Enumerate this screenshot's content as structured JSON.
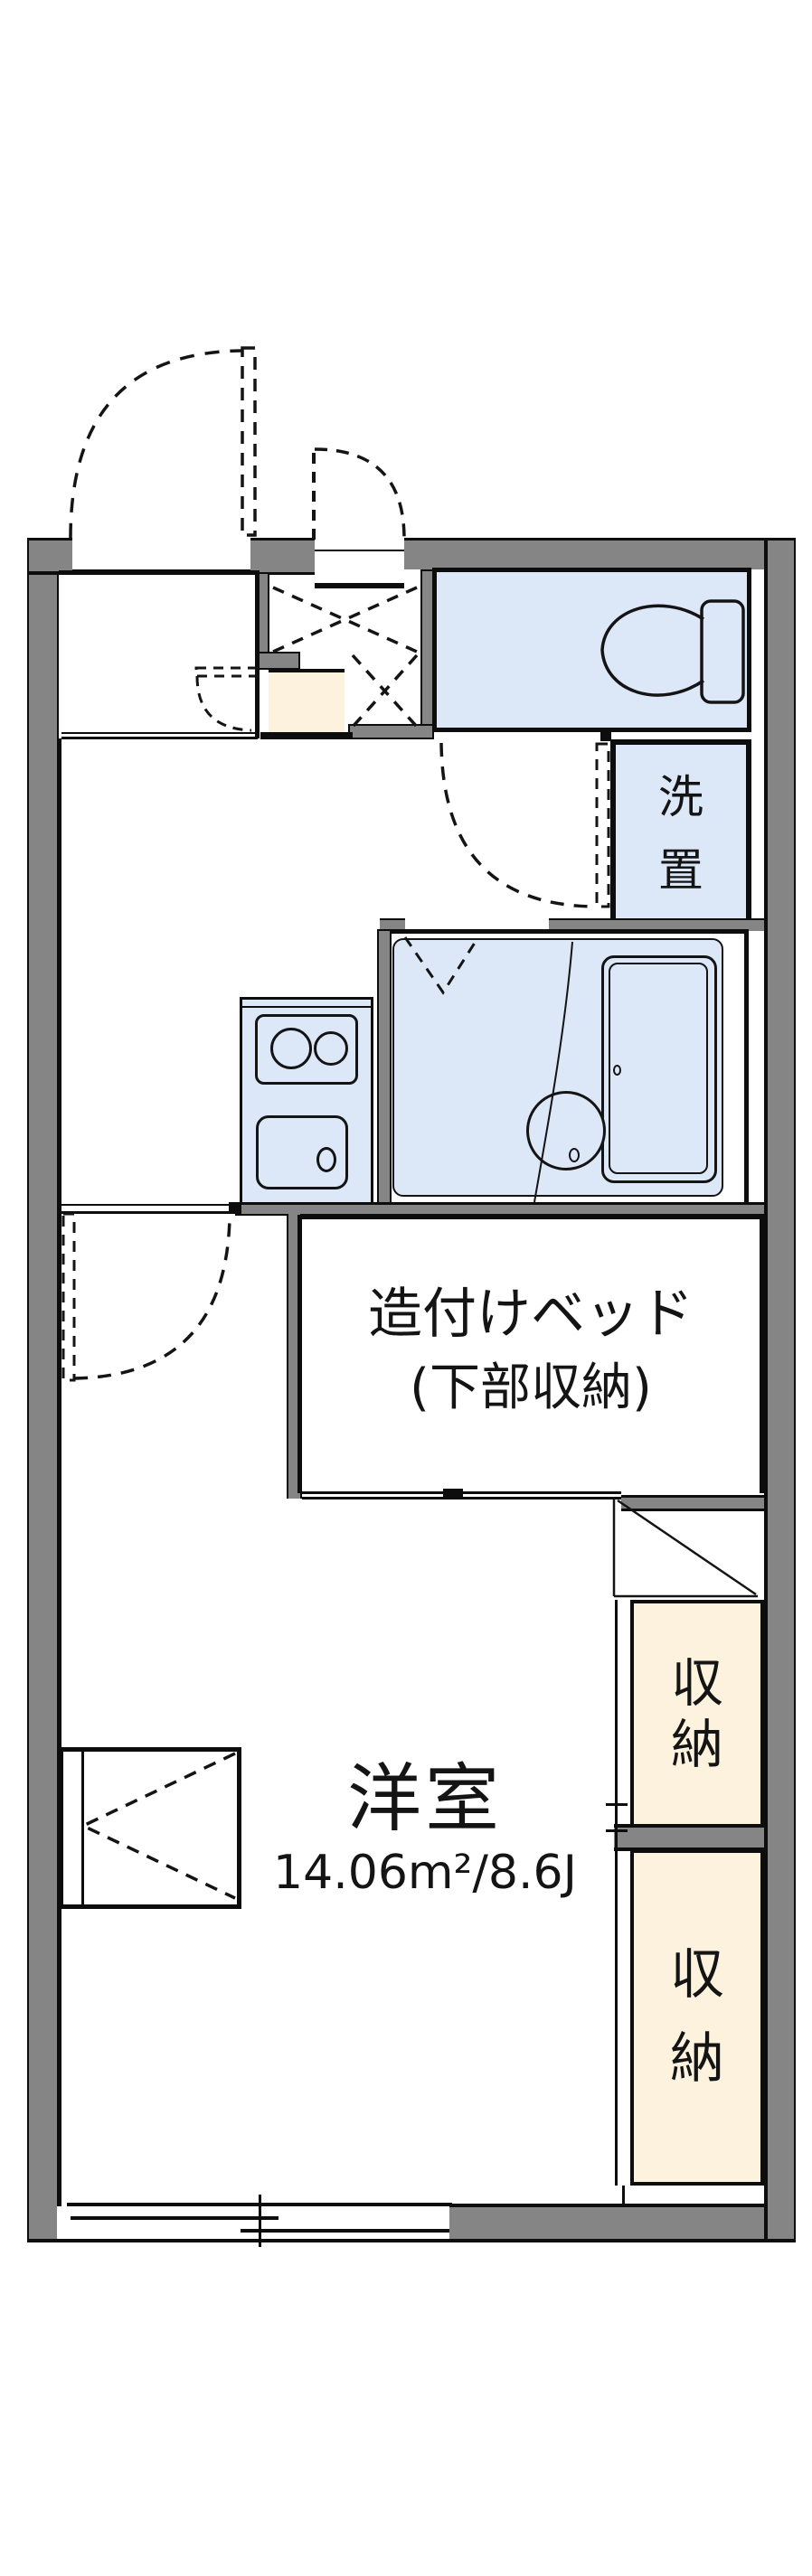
{
  "floor_plan": {
    "labels": {
      "bed_line1": "造付けベッド",
      "bed_line2": "(下部収納)",
      "room_name": "洋室",
      "room_area": "14.06m²/8.6J",
      "laundry": "洗\n置",
      "storage_upper": "収\n納",
      "storage_lower": "収\n納"
    },
    "colors": {
      "wall_gray": "#858585",
      "wet_area_blue": "#dce8f8",
      "storage_cream": "#fcf2de",
      "line_black": "#0d0d0d"
    }
  }
}
